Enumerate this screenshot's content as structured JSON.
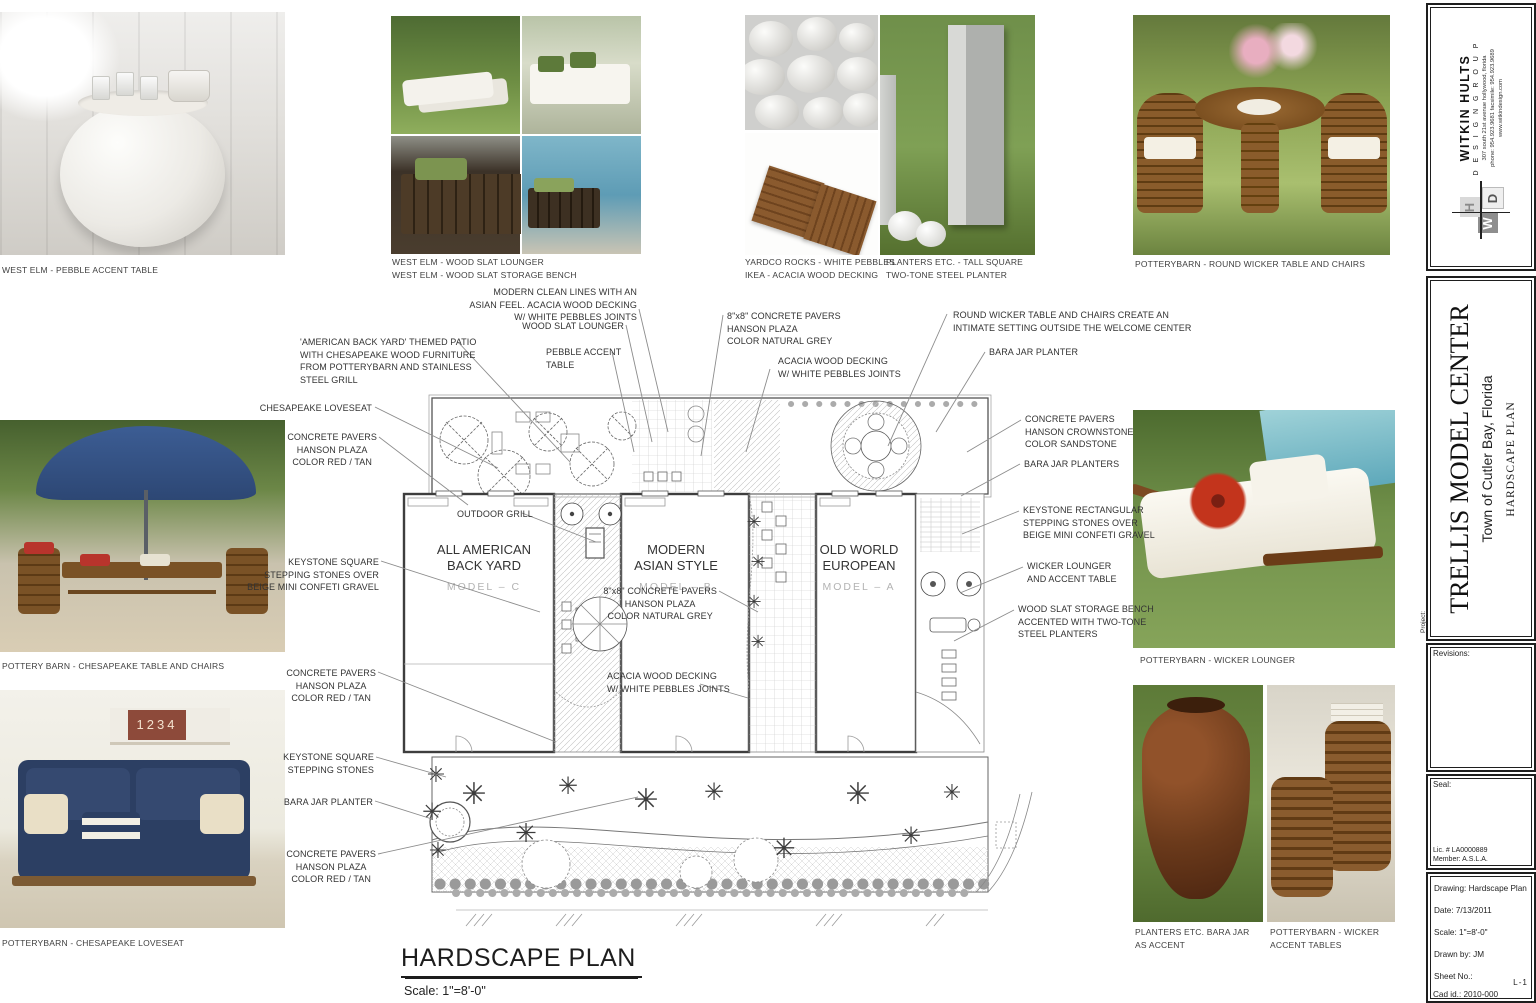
{
  "colors": {
    "leader": "#8c8c8c",
    "model_grey": "#b3b3b3",
    "accent_navy": "#2c3f63",
    "accent_green": "#6f8f45",
    "accent_brown": "#6b3a1b"
  },
  "photos": {
    "pebble_table": {
      "caption": "WEST ELM - PEBBLE ACCENT TABLE"
    },
    "west_elm": {
      "caption": "WEST ELM - WOOD SLAT LOUNGER\nWEST ELM - WOOD SLAT STORAGE BENCH"
    },
    "pebbles": {
      "caption": "YARDCO ROCKS - WHITE PEBBLES\nIKEA - ACACIA WOOD DECKING"
    },
    "steel_planter": {
      "caption": "PLANTERS ETC. - TALL SQUARE\nTWO-TONE STEEL PLANTER"
    },
    "round_wicker": {
      "caption": "POTTERYBARN - ROUND WICKER TABLE AND CHAIRS"
    },
    "chesapeake_table": {
      "caption": "POTTERY BARN - CHESAPEAKE TABLE AND CHAIRS"
    },
    "chesapeake_loveseat": {
      "caption": "POTTERYBARN - CHESAPEAKE LOVESEAT"
    },
    "wicker_lounger": {
      "caption": "POTTERYBARN - WICKER LOUNGER"
    },
    "bara_jar": {
      "caption": "PLANTERS ETC. BARA JAR\nAS ACCENT"
    },
    "wicker_accent": {
      "caption": "POTTERYBARN - WICKER\nACCENT TABLES"
    },
    "loveseat_box_digits": "1234"
  },
  "plan": {
    "title": "HARDSCAPE PLAN",
    "scale": "Scale: 1\"=8'-0\"",
    "models": [
      {
        "line1": "ALL AMERICAN",
        "line2": "BACK YARD",
        "model": "MODEL – C"
      },
      {
        "line1": "MODERN",
        "line2": "ASIAN STYLE",
        "model": "MODEL – B"
      },
      {
        "line1": "OLD WORLD",
        "line2": "EUROPEAN",
        "model": "MODEL – A"
      }
    ]
  },
  "annotations": [
    {
      "id": "themed-patio",
      "lines": [
        "'AMERICAN BACK YARD' THEMED PATIO",
        "WITH CHESAPEAKE WOOD FURNITURE",
        "FROM POTTERYBARN AND STAINLESS",
        "STEEL GRILL"
      ],
      "x": 300,
      "y": 336,
      "anchor": "left",
      "ta": "left",
      "leader": [
        [
          458,
          342
        ],
        [
          570,
          462
        ]
      ]
    },
    {
      "id": "chesapeake-loveseat",
      "lines": [
        "CHESAPEAKE LOVESEAT"
      ],
      "x": 372,
      "y": 402,
      "anchor": "right",
      "ta": "right",
      "leader": [
        [
          375,
          407
        ],
        [
          498,
          468
        ]
      ]
    },
    {
      "id": "pavers-red-tan-1",
      "lines": [
        "CONCRETE PAVERS",
        "HANSON PLAZA",
        "COLOR RED / TAN"
      ],
      "x": 377,
      "y": 431,
      "anchor": "right",
      "ta": "center",
      "leader": [
        [
          379,
          437
        ],
        [
          468,
          505
        ]
      ]
    },
    {
      "id": "keystone-over-gravel",
      "lines": [
        "KEYSTONE SQUARE",
        "STEPPING STONES OVER",
        "BEIGE MINI CONFETI GRAVEL"
      ],
      "x": 379,
      "y": 556,
      "anchor": "right",
      "ta": "right",
      "leader": [
        [
          381,
          561
        ],
        [
          540,
          612
        ]
      ]
    },
    {
      "id": "pavers-red-tan-2",
      "lines": [
        "CONCRETE PAVERS",
        "HANSON PLAZA",
        "COLOR RED / TAN"
      ],
      "x": 376,
      "y": 667,
      "anchor": "right",
      "ta": "center",
      "leader": [
        [
          378,
          672
        ],
        [
          556,
          742
        ]
      ]
    },
    {
      "id": "keystone-square",
      "lines": [
        "KEYSTONE SQUARE",
        "STEPPING STONES"
      ],
      "x": 374,
      "y": 751,
      "anchor": "right",
      "ta": "right",
      "leader": [
        [
          376,
          757
        ],
        [
          446,
          777
        ]
      ]
    },
    {
      "id": "bara-jar-planter-left",
      "lines": [
        "BARA JAR PLANTER"
      ],
      "x": 373,
      "y": 796,
      "anchor": "right",
      "ta": "right",
      "leader": [
        [
          375,
          801
        ],
        [
          432,
          819
        ]
      ]
    },
    {
      "id": "pavers-red-tan-3",
      "lines": [
        "CONCRETE PAVERS",
        "HANSON PLAZA",
        "COLOR RED / TAN"
      ],
      "x": 376,
      "y": 848,
      "anchor": "right",
      "ta": "center",
      "leader": [
        [
          378,
          854
        ],
        [
          638,
          797
        ]
      ]
    },
    {
      "id": "modern-clean-lines",
      "lines": [
        "MODERN CLEAN LINES WITH AN",
        "ASIAN FEEL. ACACIA WOOD DECKING",
        "W/ WHITE PEBBLES JOINTS"
      ],
      "x": 637,
      "y": 286,
      "anchor": "right",
      "ta": "right",
      "leader": [
        [
          639,
          309
        ],
        [
          668,
          432
        ]
      ]
    },
    {
      "id": "wood-slat-lounger",
      "lines": [
        "WOOD SLAT LOUNGER"
      ],
      "x": 624,
      "y": 320,
      "anchor": "right",
      "ta": "right",
      "leader": [
        [
          626,
          325
        ],
        [
          652,
          442
        ]
      ]
    },
    {
      "id": "pebble-accent-table",
      "lines": [
        "PEBBLE ACCENT",
        "TABLE"
      ],
      "x": 546,
      "y": 346,
      "anchor": "left",
      "ta": "left",
      "leader": [
        [
          612,
          352
        ],
        [
          634,
          452
        ]
      ]
    },
    {
      "id": "pavers-natural-grey-top",
      "lines": [
        "8\"x8\" CONCRETE PAVERS",
        "HANSON PLAZA",
        "COLOR NATURAL GREY"
      ],
      "x": 727,
      "y": 310,
      "anchor": "left",
      "ta": "left",
      "leader": [
        [
          723,
          315
        ],
        [
          701,
          456
        ]
      ]
    },
    {
      "id": "acacia-decking-top",
      "lines": [
        "ACACIA WOOD DECKING",
        "W/ WHITE PEBBLES JOINTS"
      ],
      "x": 778,
      "y": 355,
      "anchor": "left",
      "ta": "left",
      "leader": [
        [
          770,
          369
        ],
        [
          746,
          452
        ]
      ]
    },
    {
      "id": "round-wicker-note",
      "lines": [
        "ROUND WICKER TABLE AND CHAIRS CREATE AN",
        "INTIMATE SETTING OUTSIDE THE WELCOME CENTER"
      ],
      "x": 953,
      "y": 309,
      "anchor": "left",
      "ta": "left",
      "leader": [
        [
          947,
          314
        ],
        [
          888,
          446
        ]
      ]
    },
    {
      "id": "bara-jar-planter-top",
      "lines": [
        "BARA JAR PLANTER"
      ],
      "x": 989,
      "y": 346,
      "anchor": "left",
      "ta": "left",
      "leader": [
        [
          985,
          352
        ],
        [
          936,
          432
        ]
      ]
    },
    {
      "id": "pavers-crownstone",
      "lines": [
        "CONCRETE PAVERS",
        "HANSON CROWNSTONE",
        "COLOR SANDSTONE"
      ],
      "x": 1025,
      "y": 413,
      "anchor": "left",
      "ta": "left",
      "leader": [
        [
          1021,
          420
        ],
        [
          967,
          452
        ]
      ]
    },
    {
      "id": "bara-jar-planters-right",
      "lines": [
        "BARA JAR PLANTERS"
      ],
      "x": 1024,
      "y": 458,
      "anchor": "left",
      "ta": "left",
      "leader": [
        [
          1020,
          464
        ],
        [
          961,
          496
        ]
      ]
    },
    {
      "id": "keystone-rectangular",
      "lines": [
        "KEYSTONE RECTANGULAR",
        "STEPPING STONES OVER",
        "BEIGE MINI CONFETI GRAVEL"
      ],
      "x": 1023,
      "y": 504,
      "anchor": "left",
      "ta": "left",
      "leader": [
        [
          1019,
          511
        ],
        [
          962,
          534
        ]
      ]
    },
    {
      "id": "wicker-lounger-note",
      "lines": [
        "WICKER LOUNGER",
        "AND ACCENT TABLE"
      ],
      "x": 1027,
      "y": 560,
      "anchor": "left",
      "ta": "left",
      "leader": [
        [
          1023,
          567
        ],
        [
          960,
          593
        ]
      ]
    },
    {
      "id": "wood-slat-bench-note",
      "lines": [
        "WOOD SLAT STORAGE BENCH",
        "ACCENTED WITH TWO-TONE",
        "STEEL PLANTERS"
      ],
      "x": 1018,
      "y": 603,
      "anchor": "left",
      "ta": "left",
      "leader": [
        [
          1014,
          610
        ],
        [
          954,
          641
        ]
      ]
    },
    {
      "id": "outdoor-grill",
      "lines": [
        "OUTDOOR GRILL"
      ],
      "x": 457,
      "y": 508,
      "anchor": "left",
      "ta": "left",
      "leader": [
        [
          522,
          513
        ],
        [
          596,
          542
        ]
      ]
    },
    {
      "id": "pavers-natural-grey-mid",
      "lines": [
        "8\"x8\" CONCRETE PAVERS",
        "HANSON PLAZA",
        "COLOR NATURAL GREY"
      ],
      "x": 717,
      "y": 585,
      "anchor": "right",
      "ta": "center",
      "leader": [
        [
          719,
          591
        ],
        [
          758,
          612
        ]
      ]
    },
    {
      "id": "acacia-decking-mid",
      "lines": [
        "ACACIA WOOD DECKING",
        "W/ WHITE PEBBLES JOINTS"
      ],
      "x": 607,
      "y": 670,
      "anchor": "left",
      "ta": "left",
      "leader": [
        [
          700,
          684
        ],
        [
          748,
          698
        ]
      ]
    }
  ],
  "titleblock": {
    "firm_name": "WITKIN HULTS",
    "firm_sub": "D E S I G N   G R O U P",
    "firm_addr1": "307 south 21st avenue   hollywood, florida",
    "firm_addr2": "phone: 954.923.9681   facsimile: 954.923.9689",
    "firm_web": "www.witkindesign.com",
    "mono_w": "W",
    "mono_h": "H",
    "mono_d": "D",
    "project_label": "Project:",
    "project_name": "TRELLIS MODEL CENTER",
    "project_location": "Town of Cutler Bay, Florida",
    "sheet_title": "HARDSCAPE PLAN",
    "revisions_label": "Revisions:",
    "seal_label": "Seal:",
    "lic": "Lic. # LA0000889\nMember: A.S.L.A.",
    "drawing": "Drawing: Hardscape Plan",
    "date": "Date:  7/13/2011",
    "scale": "Scale:  1\"=8'-0\"",
    "drawn_by": "Drawn by: JM",
    "sheet_no": "Sheet No.:",
    "sheet_id": "L-1",
    "cad_id": "Cad id.: 2010-000"
  }
}
